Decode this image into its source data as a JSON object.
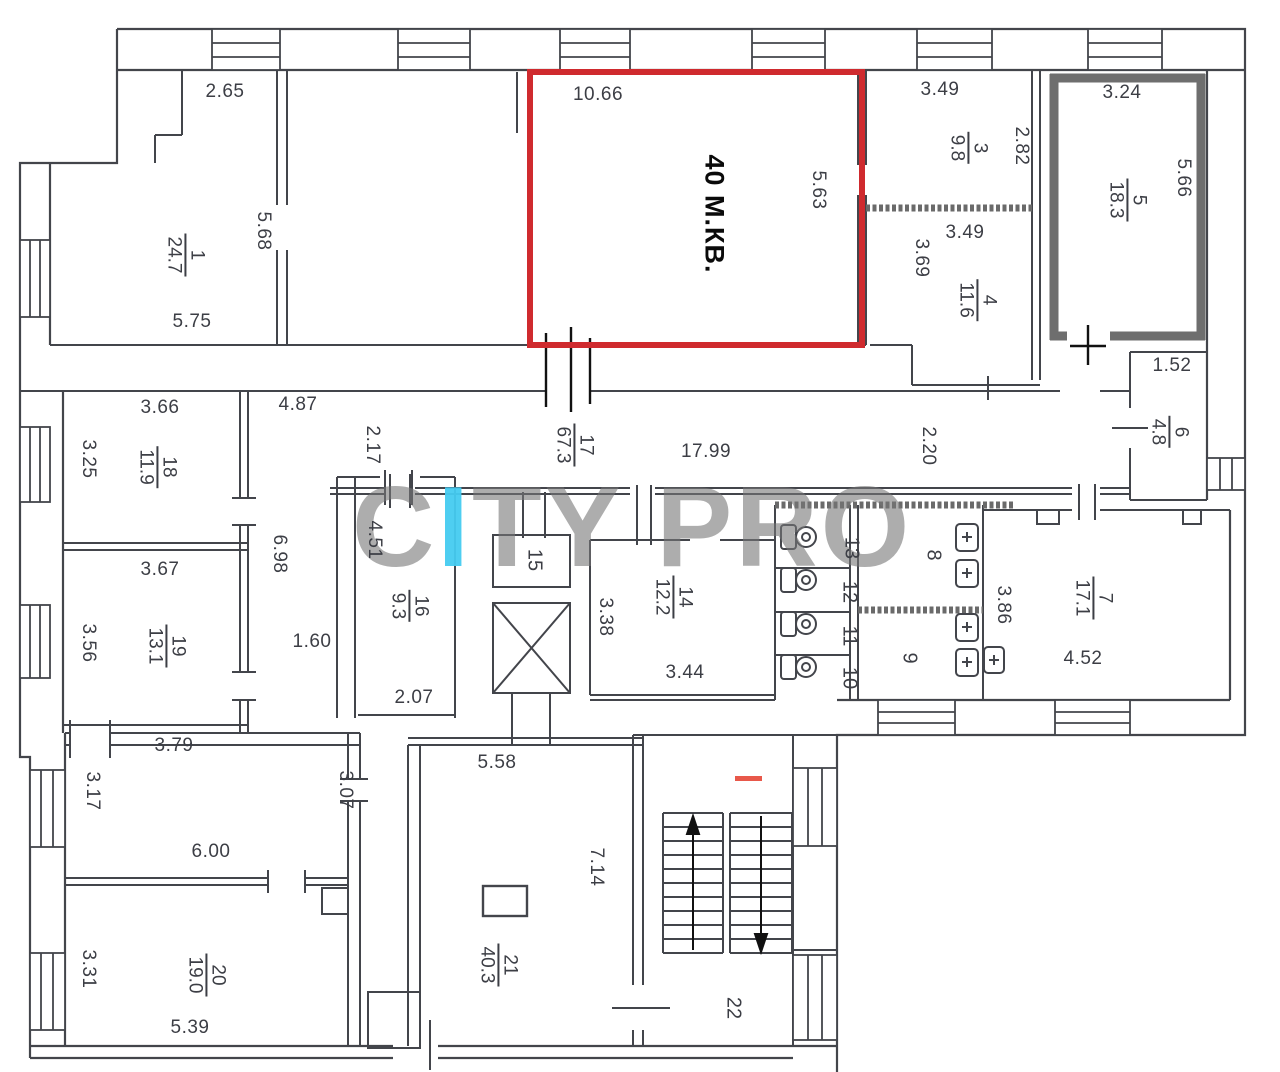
{
  "plan_title": "floor-plan",
  "colors": {
    "wall": "#43454b",
    "red_outline": "#cf2a2e",
    "gray_outline": "#6e6e6e",
    "watermark_gray": "#767676",
    "watermark_cyan": "#44cbf0",
    "stair_dash": "#e8584a"
  },
  "watermark": {
    "pre": "C",
    "i": "I",
    "post": "TY PRO"
  },
  "red_room": {
    "text": "40 М.КВ."
  },
  "labels": {
    "dims": [
      {
        "t": "2.65",
        "x": 225,
        "y": 92,
        "rot": 0
      },
      {
        "t": "10.66",
        "x": 598,
        "y": 95,
        "rot": 0
      },
      {
        "t": "3.49",
        "x": 940,
        "y": 90,
        "rot": 0
      },
      {
        "t": "3.24",
        "x": 1122,
        "y": 93,
        "rot": 0
      },
      {
        "t": "5.75",
        "x": 192,
        "y": 322,
        "rot": 0
      },
      {
        "t": "3.49",
        "x": 965,
        "y": 233,
        "rot": 0
      },
      {
        "t": "1.52",
        "x": 1172,
        "y": 366,
        "rot": 0
      },
      {
        "t": "4.87",
        "x": 298,
        "y": 405,
        "rot": 0
      },
      {
        "t": "17.99",
        "x": 706,
        "y": 452,
        "rot": 0
      },
      {
        "t": "3.66",
        "x": 160,
        "y": 408,
        "rot": 0
      },
      {
        "t": "3.67",
        "x": 160,
        "y": 570,
        "rot": 0
      },
      {
        "t": "1.60",
        "x": 312,
        "y": 642,
        "rot": 0
      },
      {
        "t": "2.07",
        "x": 414,
        "y": 698,
        "rot": 0
      },
      {
        "t": "3.44",
        "x": 685,
        "y": 673,
        "rot": 0
      },
      {
        "t": "4.52",
        "x": 1083,
        "y": 659,
        "rot": 0
      },
      {
        "t": "3.79",
        "x": 174,
        "y": 746,
        "rot": 0
      },
      {
        "t": "6.00",
        "x": 211,
        "y": 852,
        "rot": 0
      },
      {
        "t": "5.39",
        "x": 190,
        "y": 1028,
        "rot": 0
      },
      {
        "t": "5.58",
        "x": 497,
        "y": 763,
        "rot": 0
      },
      {
        "t": "5.68",
        "x": 263,
        "y": 231,
        "rot": 1
      },
      {
        "t": "5.63",
        "x": 818,
        "y": 190,
        "rot": 1
      },
      {
        "t": "2.82",
        "x": 1021,
        "y": 146,
        "rot": 1
      },
      {
        "t": "3.69",
        "x": 921,
        "y": 258,
        "rot": 1
      },
      {
        "t": "5.66",
        "x": 1183,
        "y": 178,
        "rot": 1
      },
      {
        "t": "2.17",
        "x": 372,
        "y": 445,
        "rot": 1
      },
      {
        "t": "2.20",
        "x": 928,
        "y": 446,
        "rot": 1
      },
      {
        "t": "3.25",
        "x": 88,
        "y": 459,
        "rot": 1
      },
      {
        "t": "3.56",
        "x": 88,
        "y": 643,
        "rot": 1
      },
      {
        "t": "6.98",
        "x": 279,
        "y": 554,
        "rot": 1
      },
      {
        "t": "4.51",
        "x": 374,
        "y": 540,
        "rot": 1
      },
      {
        "t": "3.38",
        "x": 605,
        "y": 617,
        "rot": 1
      },
      {
        "t": "3.86",
        "x": 1003,
        "y": 605,
        "rot": 1
      },
      {
        "t": "3.17",
        "x": 92,
        "y": 791,
        "rot": 1
      },
      {
        "t": "3.31",
        "x": 88,
        "y": 969,
        "rot": 1
      },
      {
        "t": "3.07",
        "x": 345,
        "y": 790,
        "rot": 1
      },
      {
        "t": "7.14",
        "x": 596,
        "y": 867,
        "rot": 1
      }
    ],
    "rooms": [
      {
        "n": "1",
        "a": "24.7",
        "x": 185,
        "y": 255
      },
      {
        "n": "3",
        "a": "9.8",
        "x": 968,
        "y": 148
      },
      {
        "n": "4",
        "a": "11.6",
        "x": 977,
        "y": 300
      },
      {
        "n": "5",
        "a": "18.3",
        "x": 1127,
        "y": 200
      },
      {
        "n": "6",
        "a": "4.8",
        "x": 1169,
        "y": 432
      },
      {
        "n": "7",
        "a": "17.1",
        "x": 1093,
        "y": 598
      },
      {
        "n": "14",
        "a": "12.2",
        "x": 673,
        "y": 597
      },
      {
        "n": "16",
        "a": "9.3",
        "x": 409,
        "y": 606
      },
      {
        "n": "17",
        "a": "67.3",
        "x": 574,
        "y": 445
      },
      {
        "n": "18",
        "a": "11.9",
        "x": 157,
        "y": 467
      },
      {
        "n": "19",
        "a": "13.1",
        "x": 166,
        "y": 646
      },
      {
        "n": "20",
        "a": "19.0",
        "x": 206,
        "y": 975
      },
      {
        "n": "21",
        "a": "40.3",
        "x": 498,
        "y": 965
      }
    ],
    "numbers": [
      {
        "n": "15",
        "x": 534,
        "y": 560
      },
      {
        "n": "22",
        "x": 733,
        "y": 1008
      },
      {
        "n": "13",
        "x": 851,
        "y": 548
      },
      {
        "n": "12",
        "x": 849,
        "y": 592
      },
      {
        "n": "11",
        "x": 849,
        "y": 636
      },
      {
        "n": "10",
        "x": 849,
        "y": 678
      },
      {
        "n": "8",
        "x": 933,
        "y": 555
      },
      {
        "n": "9",
        "x": 909,
        "y": 658
      }
    ]
  }
}
